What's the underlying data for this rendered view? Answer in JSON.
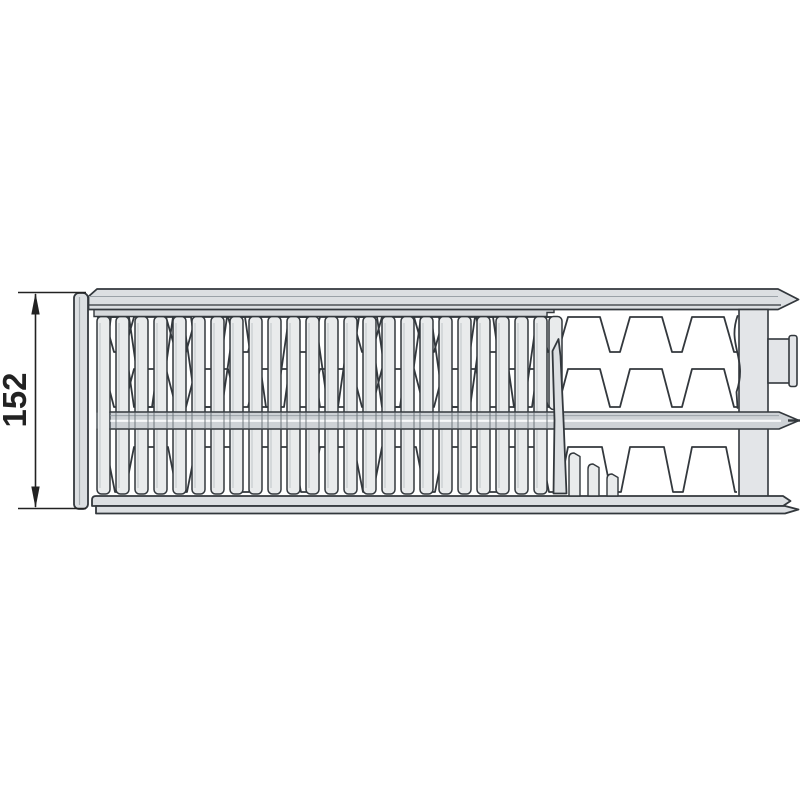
{
  "diagram": {
    "dimension": {
      "value": "152"
    },
    "colors": {
      "outline": "#33383d",
      "slat_fill": "#e9ebec",
      "panel_fill": "#dcdfe2",
      "band_fill": "#ced2d6",
      "header_fill": "#e3e5e8",
      "strip_fill": "#d6d9dc",
      "background": "#ffffff",
      "text": "#222222"
    }
  }
}
